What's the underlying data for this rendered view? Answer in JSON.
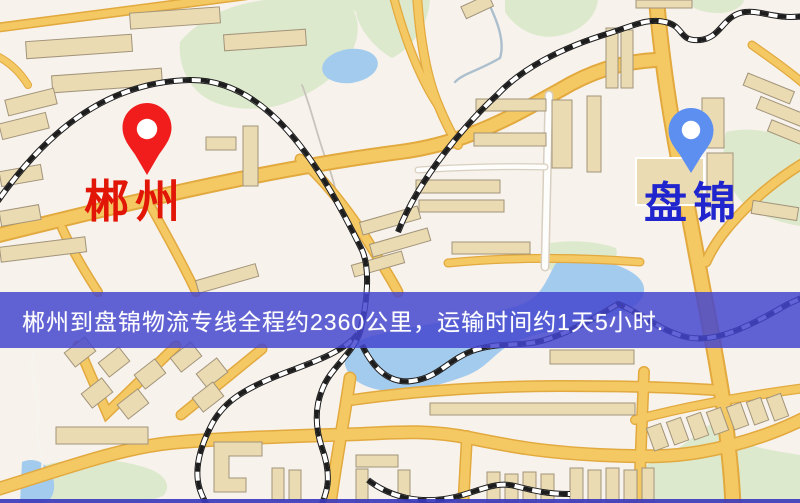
{
  "window": {
    "width": 800,
    "height": 503,
    "type": "logistics-route-map"
  },
  "map": {
    "origin": {
      "name": "郴州",
      "pin_color": "#f11d1d",
      "label_color": "#e11607"
    },
    "destination": {
      "name": "盘锦",
      "pin_color": "#5d8ff0",
      "label_color": "#2125cd"
    }
  },
  "banner": {
    "text": "郴州到盘锦物流专线全程约2360公里，运输时间约1天5小时.",
    "background_color": "#4345ce",
    "text_color": "#ffffff"
  },
  "palette": {
    "map_background": "#f7f2ec",
    "road_yellow": "#f4c964",
    "road_casing": "#e2a93e",
    "minor_road_white": "#fdfdfb",
    "water_blue": "#a3cbee",
    "park_green": "#dde9cd",
    "building_fill": "#eadbb2",
    "building_stroke": "#a2947a",
    "railway_dark": "#1d1d1d"
  }
}
